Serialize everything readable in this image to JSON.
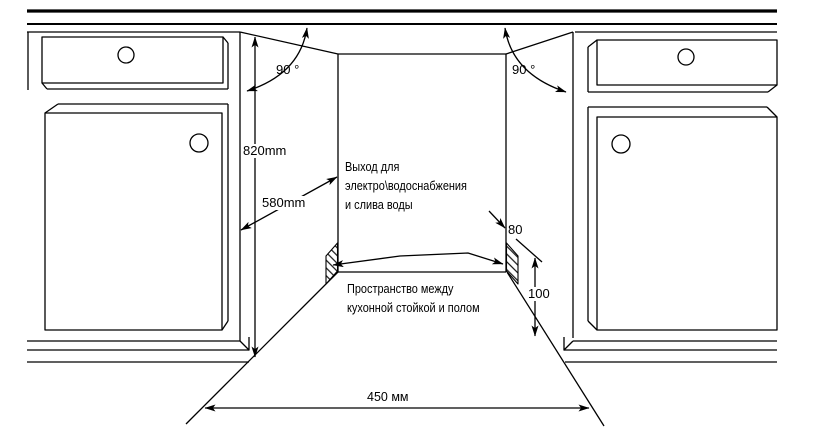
{
  "diagram": {
    "title": "appliance-niche-installation-drawing",
    "dimensions": {
      "angle_left": "90 °",
      "angle_right": "90 °",
      "niche_height": "820mm",
      "niche_depth": "580mm",
      "plinth_depth": "80",
      "plinth_height": "100",
      "niche_width": "450 мм"
    },
    "labels": {
      "utilities": [
        "Выход для",
        "электро\\водоснабжения",
        "и слива воды"
      ],
      "plinth_space": [
        "Пространство между",
        "кухонной стойкой и полом"
      ]
    },
    "colors": {
      "line": "#000000",
      "background": "#ffffff"
    }
  }
}
